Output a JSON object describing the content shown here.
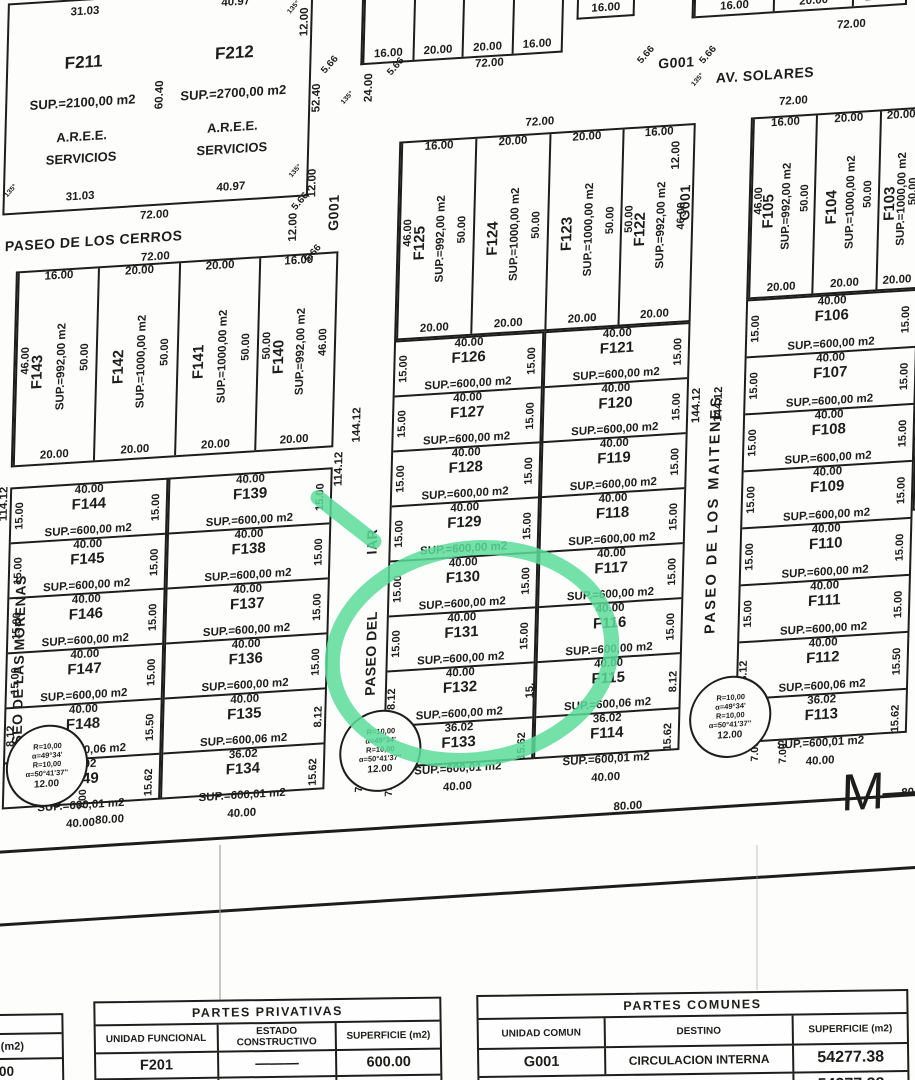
{
  "colors": {
    "ink": "#1d1d1b",
    "highlight": "#5bdc99",
    "paper": "#fdfdfc"
  },
  "streets": {
    "cerros": "PASEO DE LOS CERROS",
    "morenas": "PASEO DE LAS MORENAS",
    "central": "PASEO DEL",
    "central_end": "IAR",
    "maitenes": "PASEO DE LOS MAITENES",
    "solares": "AV. SOLARES",
    "g001": "G001"
  },
  "section_label": "M—",
  "dims": {
    "d72": "72.00",
    "d80": "80.00",
    "d80s": "80.",
    "d40": "40.00",
    "d20": "20.00",
    "d16": "16.00",
    "d12": "12.00",
    "d24": "24.00",
    "d566": "5.66",
    "d135": "135°",
    "d5240": "52.40",
    "d6040": "60.40",
    "d14412": "144.12",
    "d11412": "114.12",
    "d700": "7.00"
  },
  "roundabout": {
    "r": "R=10,00",
    "a1": "α=49°34'",
    "a2": "α=50°41'37''",
    "w": "12.00"
  },
  "block_a": [
    {
      "id": "F211",
      "sup": "SUP.=2100,00 m2",
      "a1": "A.R.E.E.",
      "a2": "SERVICIOS",
      "top": "31.03",
      "bottom": "31.03"
    },
    {
      "id": "F212",
      "sup": "SUP.=2700,00 m2",
      "a1": "A.R.E.E.",
      "a2": "SERVICIOS",
      "top": "40.97",
      "bottom": "40.97"
    }
  ],
  "block_b_top": [
    {
      "w": "16.00",
      "id": "F143",
      "sup": "SUP.=992,00 m2",
      "d": "50.00",
      "d2": "46.00",
      "b": "20.00"
    },
    {
      "w": "20.00",
      "id": "F142",
      "sup": "SUP.=1000,00 m2",
      "d": "50.00",
      "b": "20.00"
    },
    {
      "w": "20.00",
      "id": "F141",
      "sup": "SUP.=1000,00 m2",
      "d": "50.00",
      "b": "20.00"
    },
    {
      "w": "16.00",
      "id": "F140",
      "sup": "SUP.=992,00 m2",
      "d": "46.00",
      "d2": "50.00",
      "b": "20.00"
    }
  ],
  "block_b_left": [
    {
      "w": "40.00",
      "id": "F144",
      "sup": "SUP.=600,00 m2",
      "l": "15.00",
      "r": "15.00"
    },
    {
      "w": "40.00",
      "id": "F145",
      "sup": "SUP.=600,00 m2",
      "l": "15.00",
      "r": "15.00"
    },
    {
      "w": "40.00",
      "id": "F146",
      "sup": "SUP.=600,00 m2",
      "l": "15.00",
      "r": "15.00"
    },
    {
      "w": "40.00",
      "id": "F147",
      "sup": "SUP.=600,00 m2",
      "l": "15.00",
      "r": "15.00"
    },
    {
      "w": "40.00",
      "id": "F148",
      "sup": "SUP.=600,06 m2",
      "l": "8.12",
      "r": "15.50"
    },
    {
      "w": "36.02",
      "id": "F149",
      "sup": "SUP.=600,01 m2",
      "l": "",
      "r": "15.62",
      "b": "40.00"
    }
  ],
  "block_b_right": [
    {
      "w": "40.00",
      "id": "F139",
      "sup": "SUP.=600,00 m2",
      "l": "",
      "r": "15.00"
    },
    {
      "w": "40.00",
      "id": "F138",
      "sup": "SUP.=600,00 m2",
      "l": "",
      "r": "15.00"
    },
    {
      "w": "40.00",
      "id": "F137",
      "sup": "SUP.=600,00 m2",
      "l": "",
      "r": "15.00"
    },
    {
      "w": "40.00",
      "id": "F136",
      "sup": "SUP.=600,00 m2",
      "l": "",
      "r": "15.00"
    },
    {
      "w": "40.00",
      "id": "F135",
      "sup": "SUP.=600,06 m2",
      "l": "",
      "r": "8.12"
    },
    {
      "w": "36.02",
      "id": "F134",
      "sup": "SUP.=600,01 m2",
      "l": "",
      "r": "15.62",
      "b": "40.00"
    }
  ],
  "center_top": [
    {
      "w": "16.00",
      "id": "F125",
      "sup": "SUP.=992,00 m2",
      "d": "50.00",
      "d2": "46.00",
      "b": "20.00"
    },
    {
      "w": "20.00",
      "id": "F124",
      "sup": "SUP.=1000,00 m2",
      "d": "50.00",
      "b": "20.00"
    },
    {
      "w": "20.00",
      "id": "F123",
      "sup": "SUP.=1000,00 m2",
      "d": "50.00",
      "b": "20.00"
    },
    {
      "w": "16.00",
      "id": "F122",
      "sup": "SUP.=992,00 m2",
      "d": "46.00",
      "d2": "50.00",
      "b": "20.00"
    }
  ],
  "center_left": [
    {
      "w": "40.00",
      "id": "F126",
      "sup": "SUP.=600,00 m2",
      "l": "15.00",
      "r": "15.00"
    },
    {
      "w": "40.00",
      "id": "F127",
      "sup": "SUP.=600,00 m2",
      "l": "15.00",
      "r": "15.00"
    },
    {
      "w": "40.00",
      "id": "F128",
      "sup": "SUP.=600,00 m2",
      "l": "15.00",
      "r": "15.00"
    },
    {
      "w": "40.00",
      "id": "F129",
      "sup": "SUP.=600,00 m2",
      "l": "15.00",
      "r": "15.00"
    },
    {
      "w": "40.00",
      "id": "F130",
      "sup": "SUP.=600,00 m2",
      "l": "15.00",
      "r": "15.00"
    },
    {
      "w": "40.00",
      "id": "F131",
      "sup": "SUP.=600,00 m2",
      "l": "15.00",
      "r": "15.00"
    },
    {
      "w": "40.00",
      "id": "F132",
      "sup": "SUP.=600,00 m2",
      "l": "8.12",
      "r": "15."
    },
    {
      "w": "36.02",
      "id": "F133",
      "sup": "SUP.=600,01 m2",
      "l": "",
      "r": "15.62",
      "b": "40.00"
    }
  ],
  "center_right": [
    {
      "w": "40.00",
      "id": "F121",
      "sup": "SUP.=600,00 m2",
      "l": "",
      "r": "15.00"
    },
    {
      "w": "40.00",
      "id": "F120",
      "sup": "SUP.=600,00 m2",
      "l": "",
      "r": "15.00"
    },
    {
      "w": "40.00",
      "id": "F119",
      "sup": "SUP.=600,00 m2",
      "l": "",
      "r": "15.00"
    },
    {
      "w": "40.00",
      "id": "F118",
      "sup": "SUP.=600,00 m2",
      "l": "",
      "r": "15.00"
    },
    {
      "w": "40.00",
      "id": "F117",
      "sup": "SUP.=600,00 m2",
      "l": "",
      "r": "15.00"
    },
    {
      "w": "40.00",
      "id": "F116",
      "sup": "SUP.=600,00 m2",
      "l": "",
      "r": "15.00"
    },
    {
      "w": "40.00",
      "id": "F115",
      "sup": "SUP.=600,06 m2",
      "l": "",
      "r": "8.12"
    },
    {
      "w": "36.02",
      "id": "F114",
      "sup": "SUP.=600,01 m2",
      "l": "",
      "r": "15.62",
      "b": "40.00"
    }
  ],
  "east_top": [
    {
      "w": "16.00",
      "id": "F105",
      "sup": "SUP.=992,00 m2",
      "d": "50.00",
      "d2": "46.00",
      "b": "20.00"
    },
    {
      "w": "20.00",
      "id": "F104",
      "sup": "SUP.=1000,00 m2",
      "d": "50.00",
      "b": "20.00"
    },
    {
      "w": "20.00",
      "id": "F103",
      "sup": "SUP.=1000,00 m2",
      "d": "50.00",
      "b": "20.00"
    }
  ],
  "east_rows": [
    {
      "w": "40.00",
      "id": "F106",
      "sup": "SUP.=600,00 m2",
      "l": "15.00",
      "r": "15.00"
    },
    {
      "w": "40.00",
      "id": "F107",
      "sup": "SUP.=600,00 m2",
      "l": "15.00",
      "r": "15.00"
    },
    {
      "w": "40.00",
      "id": "F108",
      "sup": "SUP.=600,00 m2",
      "l": "15.00",
      "r": "15.00"
    },
    {
      "w": "40.00",
      "id": "F109",
      "sup": "SUP.=600,00 m2",
      "l": "15.00",
      "r": "15.00"
    },
    {
      "w": "40.00",
      "id": "F110",
      "sup": "SUP.=600,00 m2",
      "l": "15.00",
      "r": "15.00"
    },
    {
      "w": "40.00",
      "id": "F111",
      "sup": "SUP.=600,00 m2",
      "l": "15.00",
      "r": "15.00"
    },
    {
      "w": "40.00",
      "id": "F112",
      "sup": "SUP.=600,06 m2",
      "l": "8.12",
      "r": "15.50"
    },
    {
      "w": "36.02",
      "id": "F113",
      "sup": "SUP.=600,01 m2",
      "l": "",
      "r": "15.62",
      "b": "40.00"
    }
  ],
  "east_cut": [
    {
      "l": "15.00",
      "t": "SU"
    },
    {
      "l": "15.00",
      "t": "SU"
    },
    {
      "l": "15.00",
      "t": "S"
    },
    {
      "l": "15.00",
      "t": "S"
    }
  ],
  "top_cut_center": [
    {
      "w": "16.00",
      "id": "F22",
      "s": "SU"
    },
    {
      "w": "20.00",
      "id": "F2",
      "s": "S"
    },
    {
      "w": "20.00",
      "id": "F",
      "s": ""
    },
    {
      "w": "16.00",
      "id": "",
      "s": ""
    }
  ],
  "top_cut_east": [
    {
      "w": "16.00",
      "id": "",
      "s": ""
    },
    {
      "w": "20.00",
      "id": "",
      "s": ""
    },
    {
      "w": "20.00",
      "id": "",
      "s": ""
    }
  ],
  "top_cut_lone": "16.00",
  "tables": {
    "privativas": {
      "title": "PARTES PRIVATIVAS",
      "headers": [
        "UNIDAD FUNCIONAL",
        "ESTADO CONSTRUCTIVO",
        "SUPERFICIE (m2)"
      ],
      "rows": [
        [
          "F201",
          "———",
          "600.00"
        ],
        [
          "F202",
          "———",
          "600.00"
        ]
      ]
    },
    "comunes": {
      "title": "PARTES COMUNES",
      "headers": [
        "UNIDAD COMUN",
        "DESTINO",
        "SUPERFICIE (m2)"
      ],
      "rows": [
        [
          "G001",
          "CIRCULACION INTERNA",
          "54277.38"
        ]
      ],
      "footer": [
        "SUPERFICIE TOTAL DE CIRCULACION INTERNA",
        "54277.38"
      ]
    },
    "partial": {
      "header": "FICIE (m2)",
      "rows": [
        "00.00",
        "92.00"
      ]
    }
  }
}
